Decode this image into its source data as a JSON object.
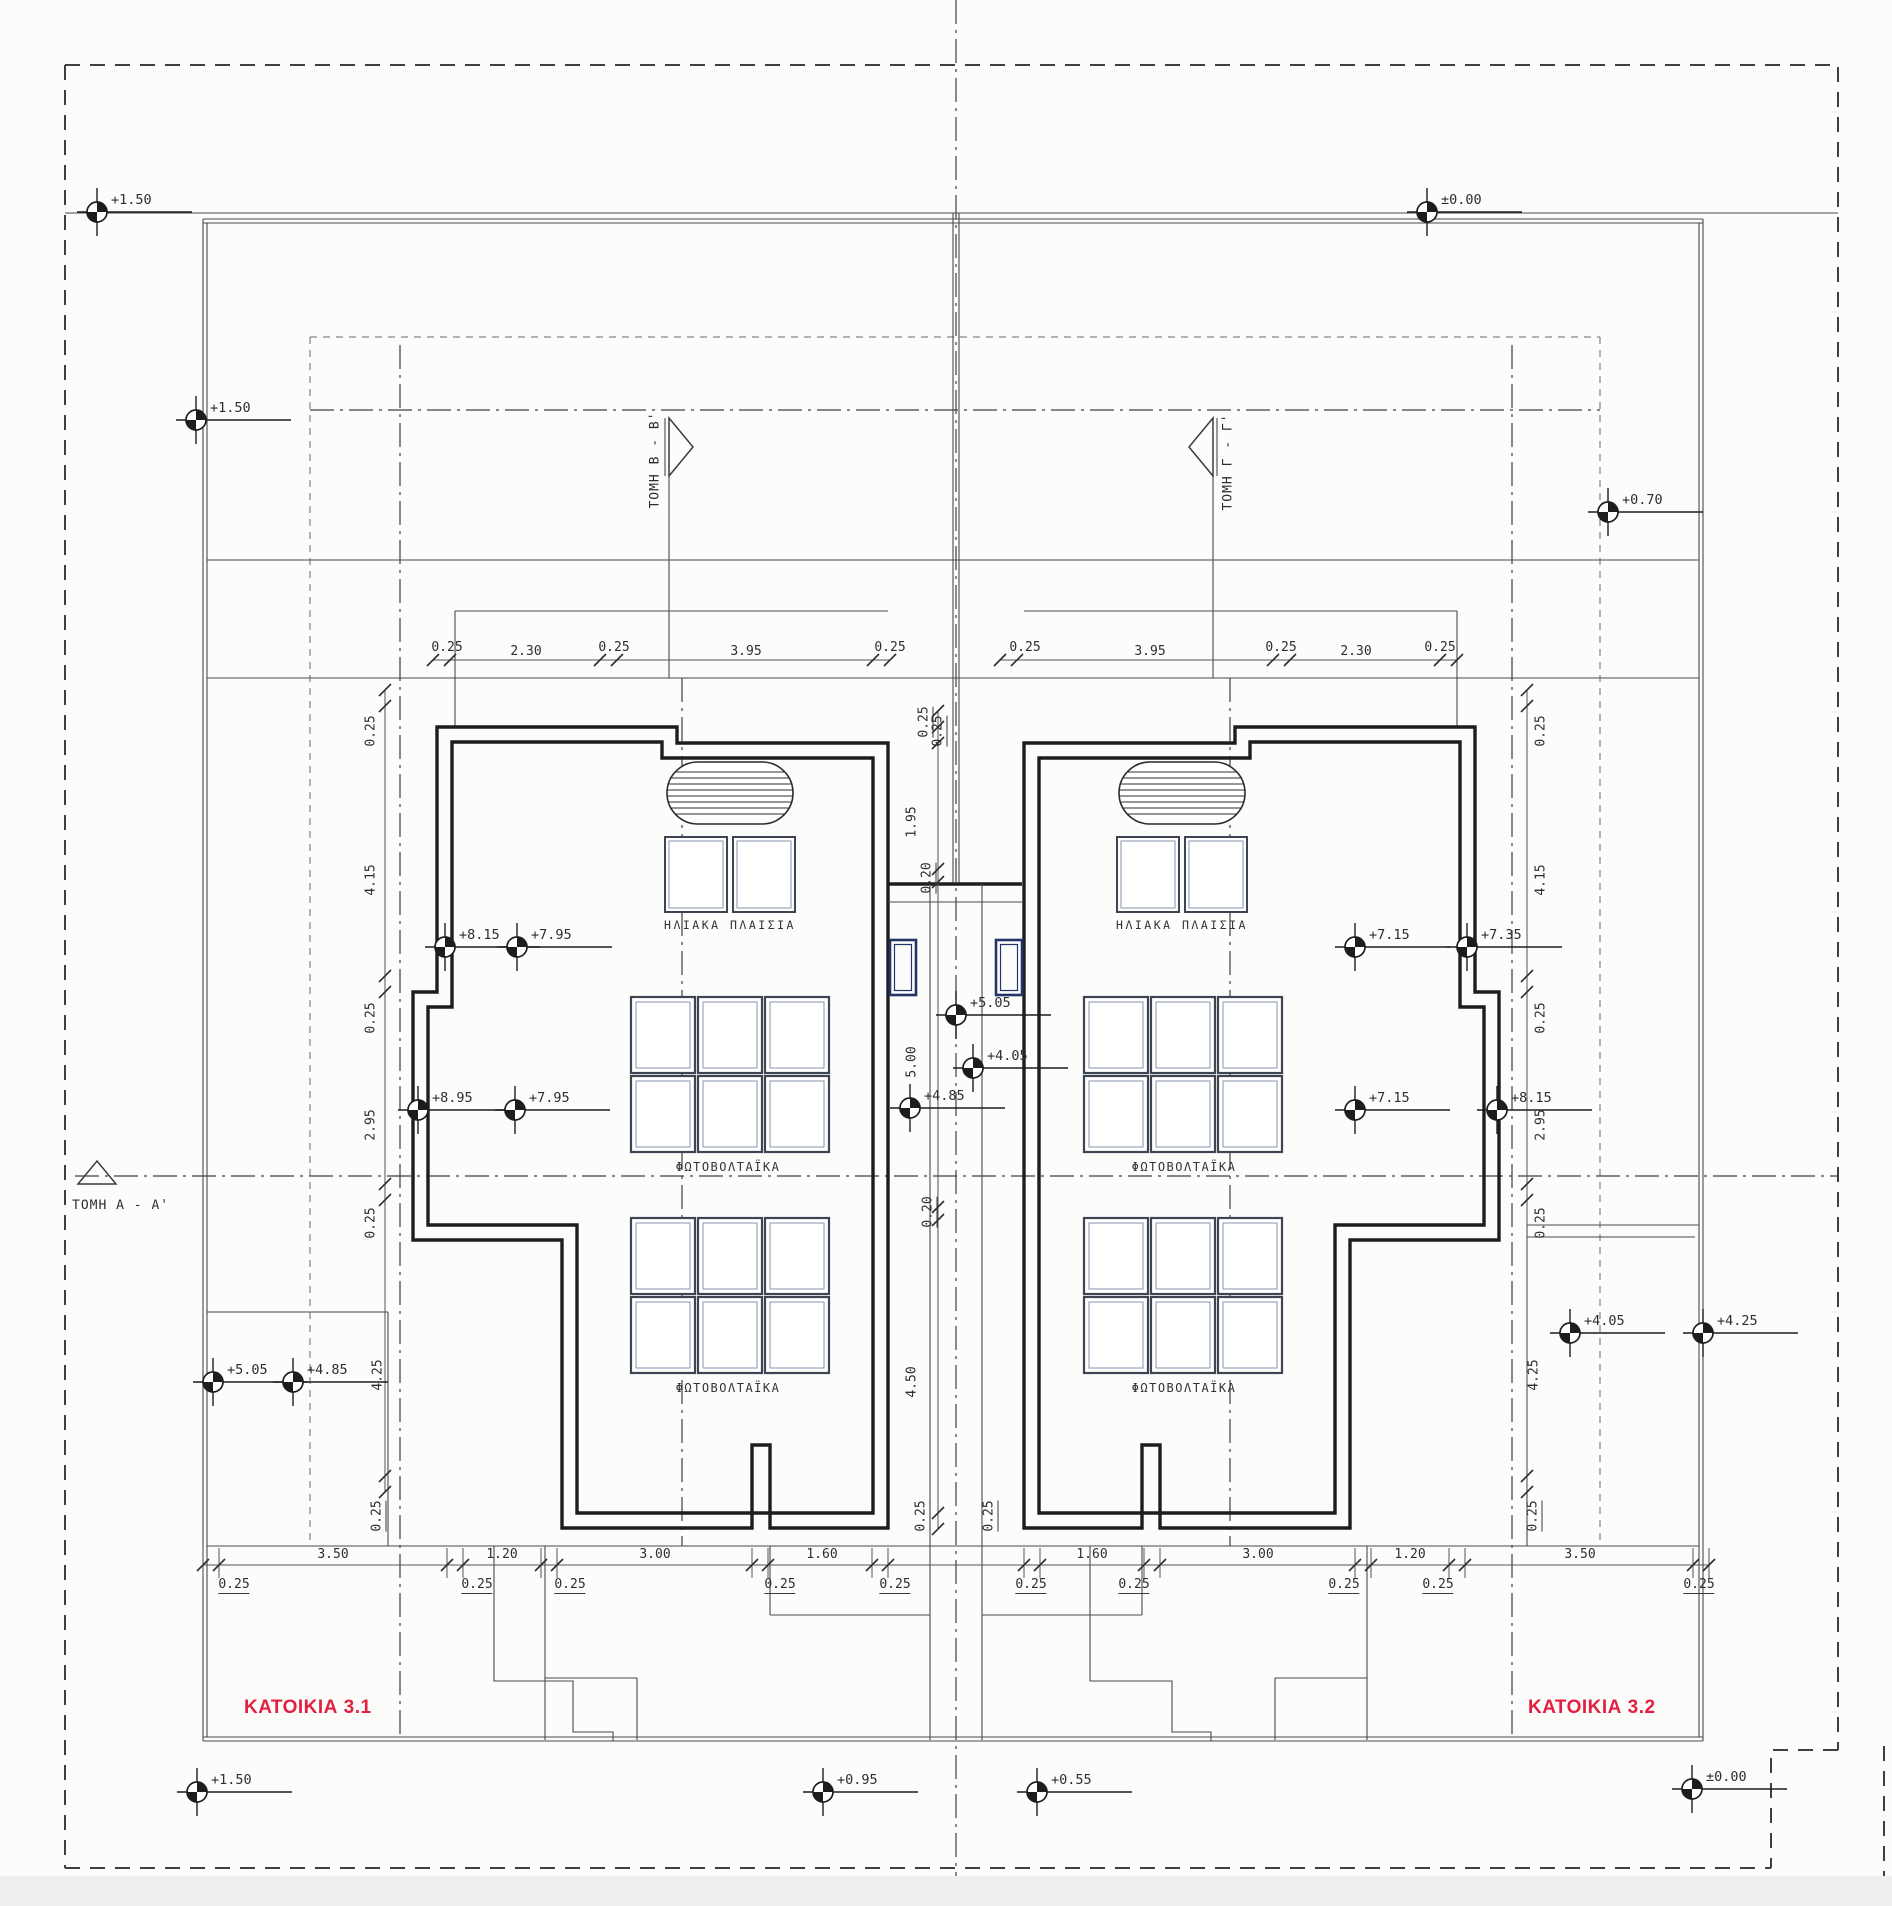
{
  "titles": {
    "left": "ΚΑΤΟΙΚΙΑ 3.1",
    "right": "ΚΑΤΟΙΚΙΑ 3.2"
  },
  "colors": {
    "title_red": "#e32040",
    "line_dark": "#2a2a2a",
    "blue_accent": "#243468"
  },
  "sections": {
    "a": "ΤΟΜΗ Α - Α'",
    "b": "ΤΟΜΗ Β - Β'",
    "g": "ΤΟΜΗ Γ - Γ'"
  },
  "roof_labels": {
    "solar": "ΗΛΙΑΚΑ ΠΛΑΙΣΙΑ",
    "pv": "ΦΩΤΟΒΟΛΤΑΪΚΑ"
  },
  "levels": {
    "top_left": "+1.50",
    "top_right": "±0.00",
    "upper_left": "+1.50",
    "upper_right": "+0.70",
    "roof_left_a1": "+8.15",
    "roof_left_a2": "+7.95",
    "roof_right_a1": "+7.15",
    "roof_right_a2": "+7.35",
    "roof_left_b1": "+8.95",
    "roof_left_b2": "+7.95",
    "roof_right_b1": "+7.15",
    "roof_right_b2": "+8.15",
    "center_a": "+5.05",
    "center_b": "+4.05",
    "center_c": "+4.85",
    "terrace_left_1": "+5.05",
    "terrace_left_2": "+4.85",
    "terrace_right_1": "+4.05",
    "terrace_right_2": "+4.25",
    "bottom_a": "+1.50",
    "bottom_b": "+0.95",
    "bottom_c": "+0.55",
    "bottom_d": "±0.00"
  },
  "dims": {
    "top_left_row": [
      "0.25",
      "2.30",
      "0.25",
      "3.95",
      "0.25"
    ],
    "top_right_row": [
      "0.25",
      "3.95",
      "0.25",
      "2.30",
      "0.25"
    ],
    "left_col": [
      "0.25",
      "4.15",
      "0.25",
      "2.95",
      "0.25",
      "4.25",
      "0.25"
    ],
    "right_col": [
      "0.25",
      "4.15",
      "0.25",
      "2.95",
      "0.25",
      "4.25",
      "0.25"
    ],
    "center_col": [
      "0.25",
      "0.25",
      "1.95",
      "0.20",
      "5.00",
      "0.20",
      "4.50",
      "0.25",
      "0.25"
    ],
    "bottom_left_row": [
      "0.25",
      "3.50",
      "0.25",
      "1.20",
      "0.25",
      "3.00",
      "0.25",
      "1.60",
      "0.25"
    ],
    "bottom_right_row": [
      "0.25",
      "1.60",
      "0.25",
      "3.00",
      "0.25",
      "1.20",
      "0.25",
      "3.50",
      "0.25"
    ]
  }
}
